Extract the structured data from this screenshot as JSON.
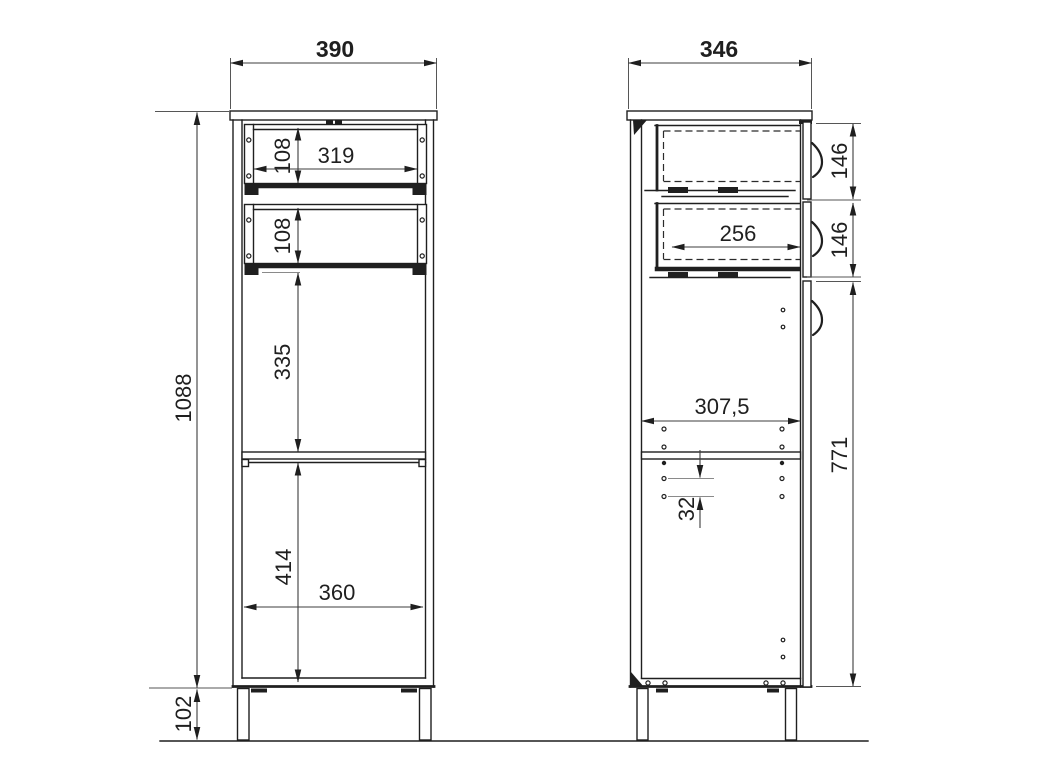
{
  "dims": {
    "front": {
      "total_width": "390",
      "total_height": "1088",
      "drawer1_height": "108",
      "drawer1_inner_width": "319",
      "drawer2_height": "108",
      "open_section_height": "335",
      "lower_section_height": "414",
      "inner_width": "360",
      "leg_height": "102"
    },
    "side": {
      "total_depth": "346",
      "drawer1_front_height": "146",
      "drawer2_front_height": "146",
      "drawer_inner_depth": "256",
      "inner_depth": "307,5",
      "hole_pitch": "32",
      "door_side_height": "771"
    }
  }
}
